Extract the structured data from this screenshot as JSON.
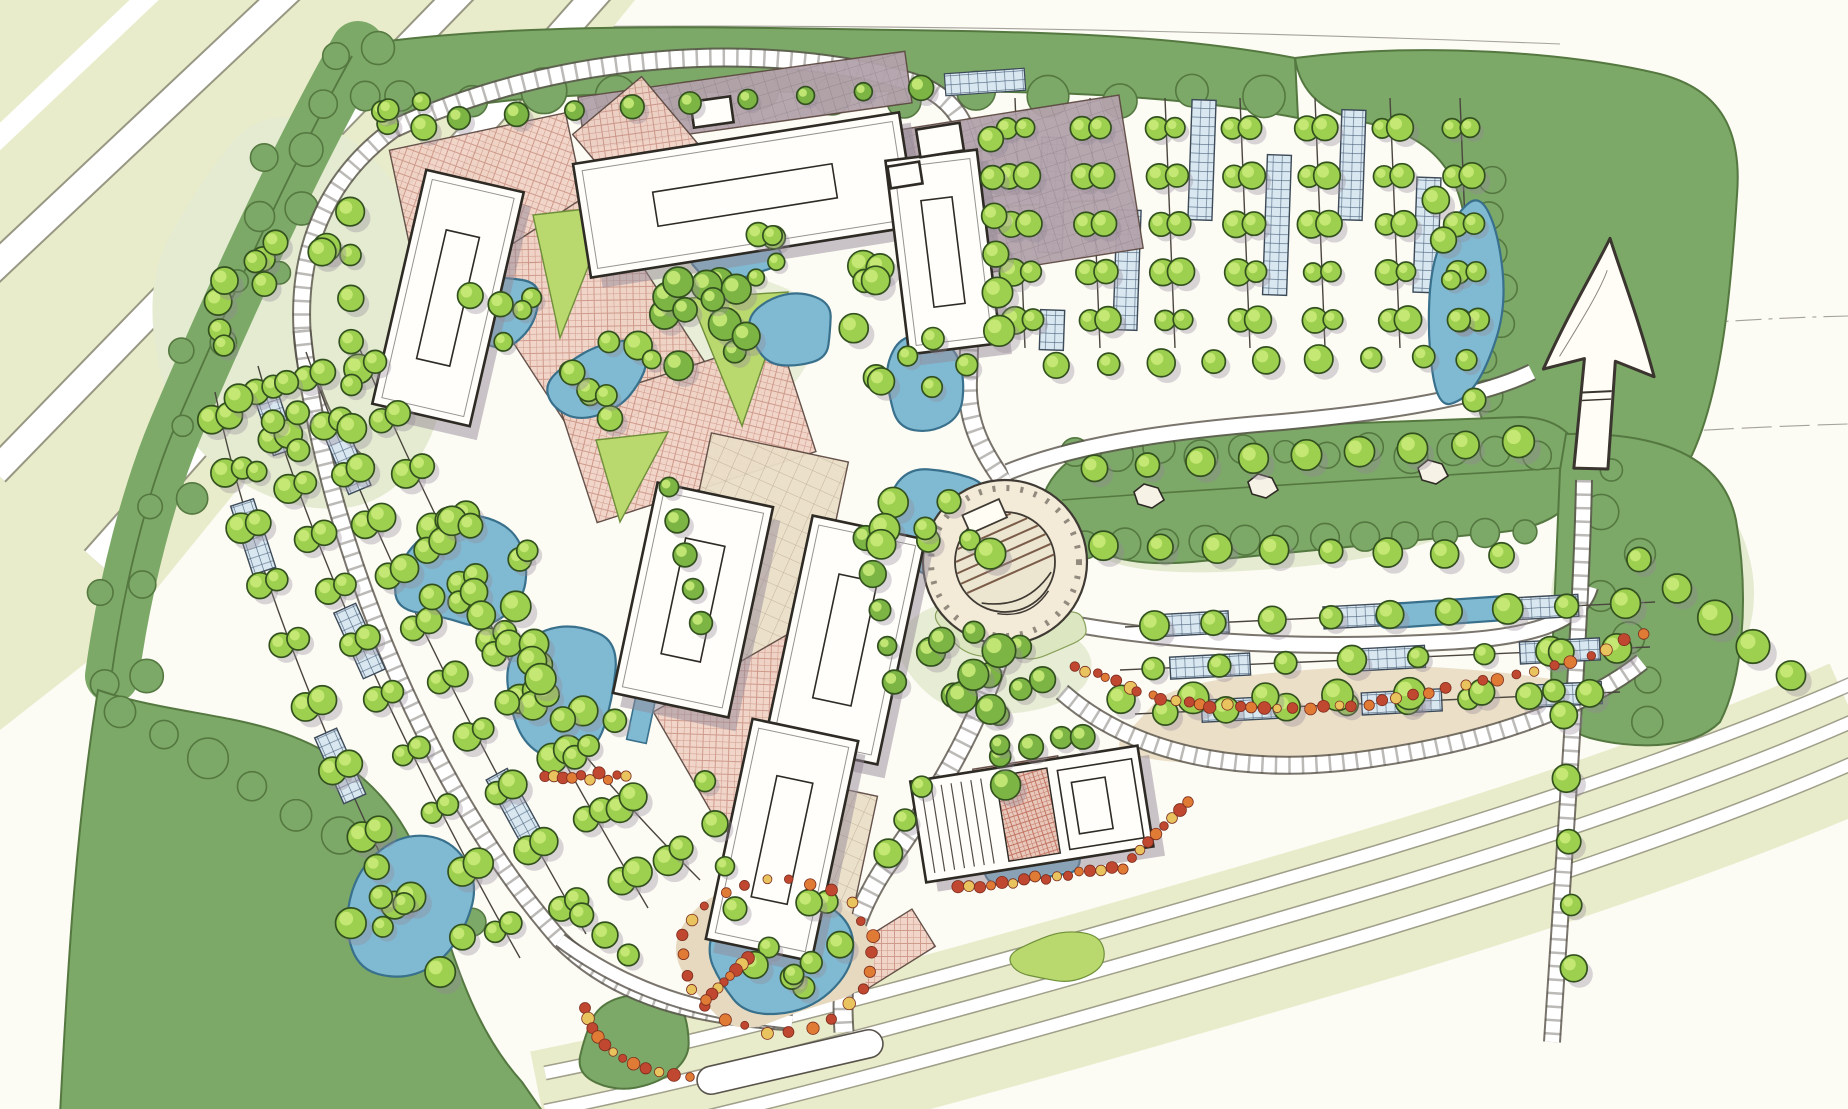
{
  "document": {
    "kind": "hand-drawn campus master plan site rendering",
    "visible_text": "none",
    "orientation": {
      "north_arrow": true,
      "pointing": "up"
    }
  },
  "palette": {
    "paper": "#fcfbf4",
    "highway": "#e9ecca",
    "sage": "#e4ebd1",
    "lawn": "#b9d86e",
    "lawn_pale": "#dce7c1",
    "forest": "#7ca868",
    "forest_dark": "#547840",
    "canopy": "#9ed04f",
    "canopy_light": "#c9ea79",
    "canopy_dark": "#7cb544",
    "tree_outline": "#33511f",
    "water": "#7fbad2",
    "water_edge": "#39708c",
    "road_edge": "#57524a",
    "plaza_pink": "#f0d3c6",
    "plaza_hatch": "#b06355",
    "plaza_tan": "#ebdfc8",
    "tan_hatch": "#a4917a",
    "mauve": "#b3a2ab",
    "mauve_dark": "#7d6f79",
    "parking_strip": "#d8e7f0",
    "strip_line": "#49607a",
    "building": "#fffefb",
    "outline": "#2e2a24",
    "shadow": "#958a97",
    "flower_red": "#c04730",
    "flower_orange": "#e07b36",
    "flower_yellow": "#e9c45e",
    "shore": "#e7d9bf"
  },
  "features": {
    "buildings": {
      "count": 7,
      "style": "white roofs with skylight slots, offset violet shadows"
    },
    "amphitheater": {
      "shape": "circular plaza with fan of steps",
      "count": 1
    },
    "ponds": {
      "count": 12,
      "style": "organic blue shapes with dark edges"
    },
    "parking_lots": {
      "count": 3,
      "style": "aisle lines, paired shade trees, hatched stall strips"
    },
    "plazas": {
      "style": "pink and tan crosshatched paving spine"
    },
    "forest_masses": {
      "style": "scalloped dark green watercolor blocks"
    },
    "flower_beds": {
      "colors": [
        "red",
        "orange",
        "yellow"
      ],
      "location": "south drives and pond edge"
    },
    "highway": {
      "location": "top-left diagonal lanes"
    },
    "boulevard": {
      "location": "bottom-right multi-lane road"
    },
    "north_arrow": {
      "location": "upper right on forest block"
    }
  }
}
